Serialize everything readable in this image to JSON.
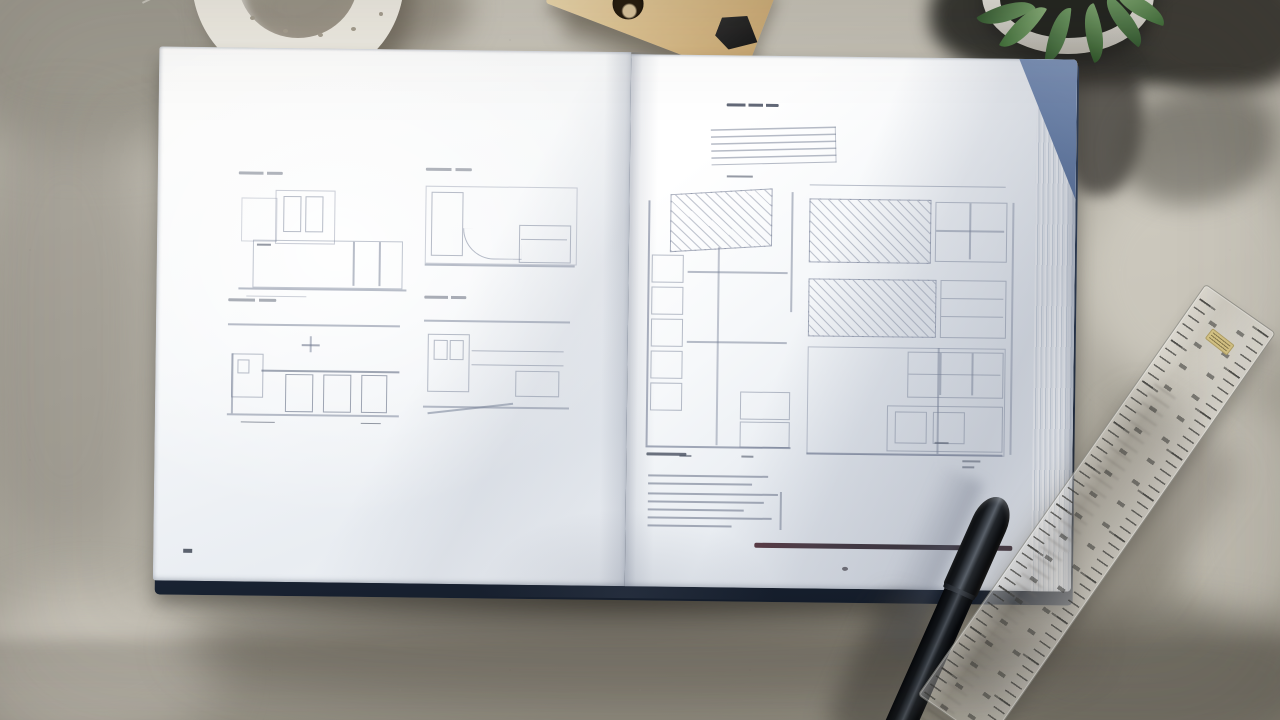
{
  "scene": {
    "type": "photograph",
    "setting": "Top-down photo of an open architecture sketchbook lying on a sunlit concrete surface",
    "legible_text": [],
    "objects": [
      {
        "name": "open-book",
        "detail": "hardcover book with dark navy cover and white pages; left page shows four faint elevation sketches in a 2x2 grid with tiny caption marks; right page shows a caption, a louver stripe diagram, a tall section drawing, a hatched facade grid drawing with dimension lines, a specification list and a dark horizontal rule"
      },
      {
        "name": "ceramic-ring",
        "detail": "white ring with small holes, top-left corner, partially out of frame, casting a shadow"
      },
      {
        "name": "wooden-tool",
        "detail": "wooden ruler piece with a round hole and a black clip, top-center, partially out of frame"
      },
      {
        "name": "succulent-plant",
        "detail": "green succulent in a round white pot sitting in deep shadow, top-right corner, partially out of frame"
      },
      {
        "name": "black-pen",
        "detail": "capped matte black pen lying diagonally across the bottom-right corner of the book"
      },
      {
        "name": "clear-ruler",
        "detail": "transparent plastic ruler with tick marks on both edges and a small yellow label, lying diagonally in the lower-right on the concrete"
      }
    ],
    "left_page": {
      "drawing_count": 4,
      "layout": "2x2 grid of faint pencil elevations"
    },
    "right_page": {
      "sections": [
        "caption-mark",
        "stripe-diagram",
        "tall-section-drawing",
        "hatched-grid-drawing",
        "specification-list",
        "dark-rule"
      ]
    }
  },
  "palette": {
    "concrete-base": "#bcb8ad",
    "concrete-light": "#cfcbc0",
    "concrete-dark": "#9b9789",
    "concrete-shadow": "#6f6b61",
    "deep-shadow": "#3f3c35",
    "page-white": "#fbfbfa",
    "page-shade": "#e2e6ec",
    "cover-navy": "#2b3950",
    "cover-dark": "#131b28",
    "blue-corner": "#5d77a3",
    "sketch-line": "#7d89a0",
    "maroon-rule": "#32222b",
    "pen-black": "#17191d",
    "wood-light": "#ecd9b0",
    "wood-dark": "#c9a873",
    "clip-black": "#161616",
    "pot-white": "#edece6",
    "soil-dark": "#22241f",
    "leaf-dark": "#33572f",
    "leaf-light": "#6f9a64",
    "ruler-label": "#d5c384",
    "ring-white": "#edeae1"
  }
}
